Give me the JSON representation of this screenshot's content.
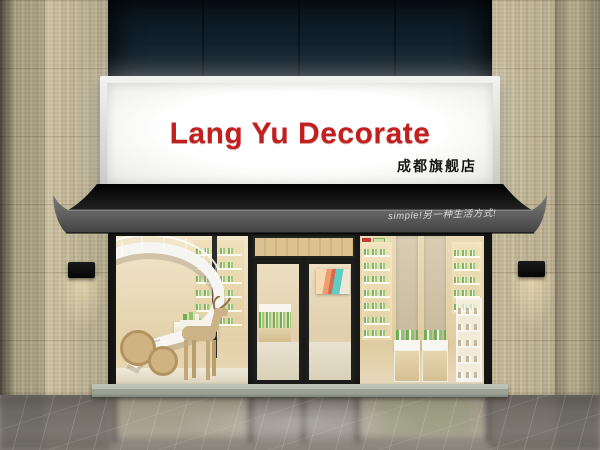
{
  "sign": {
    "title": "Lang Yu Decorate",
    "subtitle": "成都旗舰店"
  },
  "awning": {
    "slogan": "simple!另一种生活方式!"
  },
  "palette": {
    "sign_red": "#c41f1f",
    "navy_fascia": "#0d1a24",
    "tile_beige": "#cabf9e",
    "awning_black": "#121212",
    "awning_gray": "#5a5a5a",
    "frame_dark": "#1d1d1b",
    "interior_warm": "#ead9b4",
    "wood": "#d3b88c",
    "product_green": "#6fae52",
    "shelf_white": "#f4f2ec",
    "threshold_stone": "#9aa092",
    "floor_gray": "#8a847c"
  }
}
